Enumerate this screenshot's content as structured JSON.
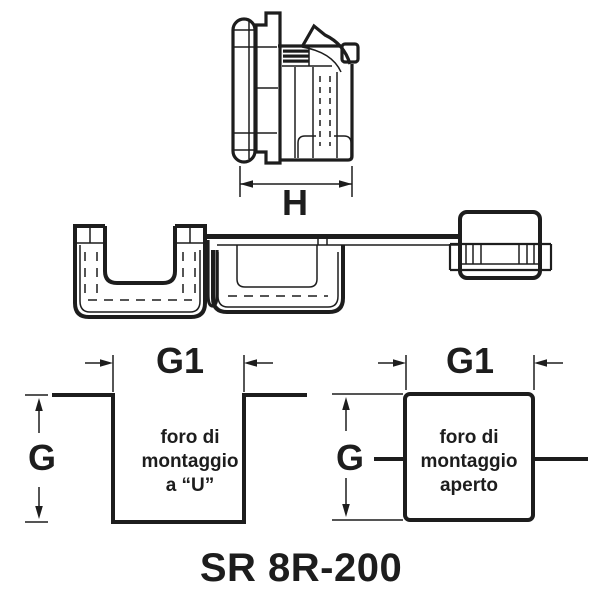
{
  "title": "SR 8R-200",
  "colors": {
    "ink": "#1d1d1d",
    "background": "#ffffff"
  },
  "top_view": {
    "height_dim": "H"
  },
  "bottom_figures": {
    "u_hole": {
      "width_dim": "G1",
      "depth_dim": "G",
      "caption": [
        "foro di",
        "montaggio",
        "a “U”"
      ]
    },
    "open_hole": {
      "width_dim": "G1",
      "depth_dim": "G",
      "caption": [
        "foro di",
        "montaggio",
        "aperto"
      ]
    }
  }
}
